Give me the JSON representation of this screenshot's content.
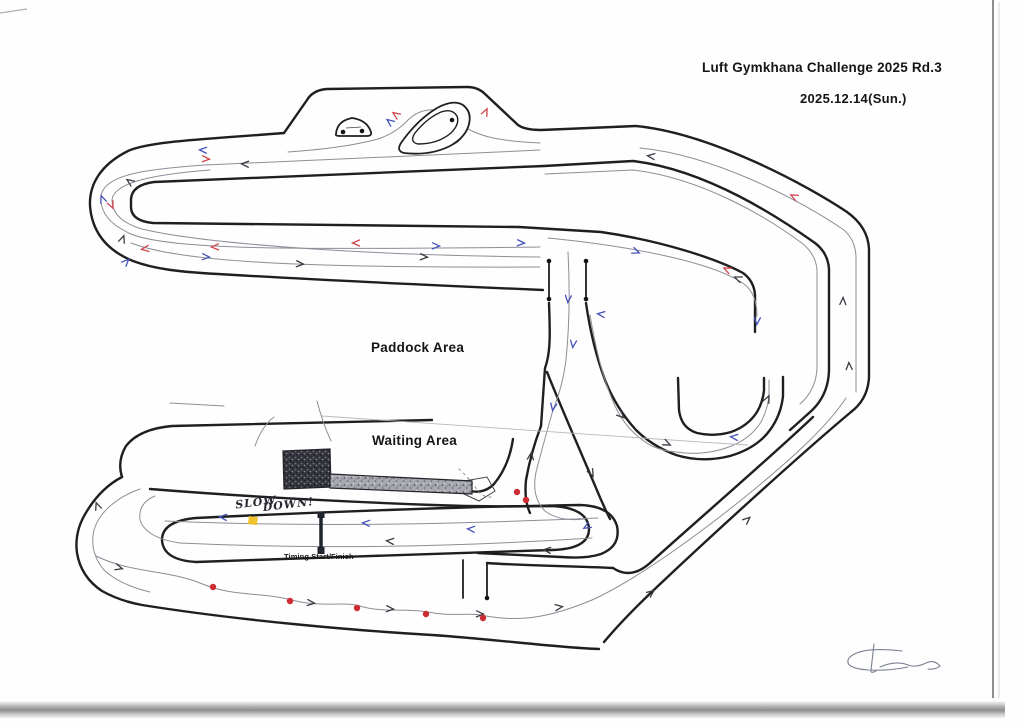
{
  "page": {
    "title_line1": "Luft Gymkhana Challenge 2025 Rd.3",
    "title_line2": "2025.12.14(Sun.)"
  },
  "map": {
    "labels": {
      "paddock": "Paddock Area",
      "waiting": "Waiting Area",
      "timing": "Timing Start/Finish",
      "slow_down_word1": "SLOW",
      "slow_down_word2": "DOWN!"
    },
    "colors": {
      "wall": "#1f1f1f",
      "racing_line": "#8d8d98",
      "arrow_red": "#d0434c",
      "arrow_blue": "#4553b8",
      "arrow_black": "#3a3a42",
      "cone_red": "#cf2b33",
      "marker_black": "#141418",
      "highlight_yellow": "#f0c01f",
      "start_finish_bar": "#20242e"
    },
    "cones_red": [
      [
        213,
        587
      ],
      [
        290,
        601
      ],
      [
        357,
        608
      ],
      [
        426,
        614
      ],
      [
        483,
        618
      ],
      [
        517,
        492
      ],
      [
        526,
        500
      ]
    ],
    "marker_dots_black": [
      [
        549,
        261
      ],
      [
        549,
        299
      ],
      [
        586,
        261
      ],
      [
        586,
        299
      ],
      [
        487,
        598
      ],
      [
        452,
        120
      ],
      [
        343,
        132
      ],
      [
        362,
        131
      ]
    ],
    "yellow_marks": [
      [
        249,
        516
      ]
    ],
    "start_finish": {
      "x": 321,
      "y_top": 512,
      "y_bottom": 554
    },
    "arrows": [
      [
        "b",
        202,
        150,
        183
      ],
      [
        "r",
        207,
        159,
        3
      ],
      [
        "k",
        244,
        164,
        183
      ],
      [
        "k",
        129,
        181,
        215
      ],
      [
        "b",
        102,
        198,
        250
      ],
      [
        "r",
        112,
        206,
        65
      ],
      [
        "k",
        123,
        238,
        290
      ],
      [
        "b",
        127,
        261,
        315
      ],
      [
        "r",
        144,
        249,
        172
      ],
      [
        "r",
        214,
        247,
        178
      ],
      [
        "b",
        207,
        257,
        4
      ],
      [
        "k",
        301,
        264,
        3
      ],
      [
        "r",
        355,
        243,
        180
      ],
      [
        "b",
        437,
        246,
        2
      ],
      [
        "k",
        425,
        257,
        3
      ],
      [
        "b",
        522,
        243,
        3
      ],
      [
        "r",
        395,
        114,
        215
      ],
      [
        "b",
        389,
        121,
        218
      ],
      [
        "r",
        486,
        111,
        295
      ],
      [
        "k",
        650,
        156,
        187
      ],
      [
        "r",
        793,
        196,
        207
      ],
      [
        "b",
        637,
        252,
        22
      ],
      [
        "r",
        726,
        269,
        205
      ],
      [
        "k",
        737,
        278,
        203
      ],
      [
        "b",
        757,
        322,
        95
      ],
      [
        "b",
        568,
        300,
        95
      ],
      [
        "b",
        573,
        345,
        97
      ],
      [
        "k",
        622,
        416,
        42
      ],
      [
        "k",
        668,
        444,
        25
      ],
      [
        "b",
        733,
        437,
        185
      ],
      [
        "k",
        768,
        398,
        295
      ],
      [
        "b",
        600,
        314,
        187
      ],
      [
        "b",
        553,
        408,
        100
      ],
      [
        "k",
        592,
        474,
        62
      ],
      [
        "k",
        531,
        455,
        278
      ],
      [
        "b",
        470,
        529,
        184
      ],
      [
        "b",
        365,
        523,
        184
      ],
      [
        "k",
        389,
        541,
        185
      ],
      [
        "b",
        222,
        517,
        185
      ],
      [
        "b",
        586,
        527,
        150
      ],
      [
        "k",
        546,
        550,
        185
      ],
      [
        "k",
        312,
        603,
        6
      ],
      [
        "k",
        391,
        609,
        4
      ],
      [
        "k",
        481,
        614,
        2
      ],
      [
        "k",
        560,
        607,
        352
      ],
      [
        "k",
        652,
        592,
        322
      ],
      [
        "k",
        748,
        519,
        318
      ],
      [
        "k",
        843,
        300,
        272
      ],
      [
        "k",
        849,
        365,
        268
      ],
      [
        "k",
        120,
        568,
        15
      ],
      [
        "k",
        97,
        505,
        250
      ]
    ]
  }
}
